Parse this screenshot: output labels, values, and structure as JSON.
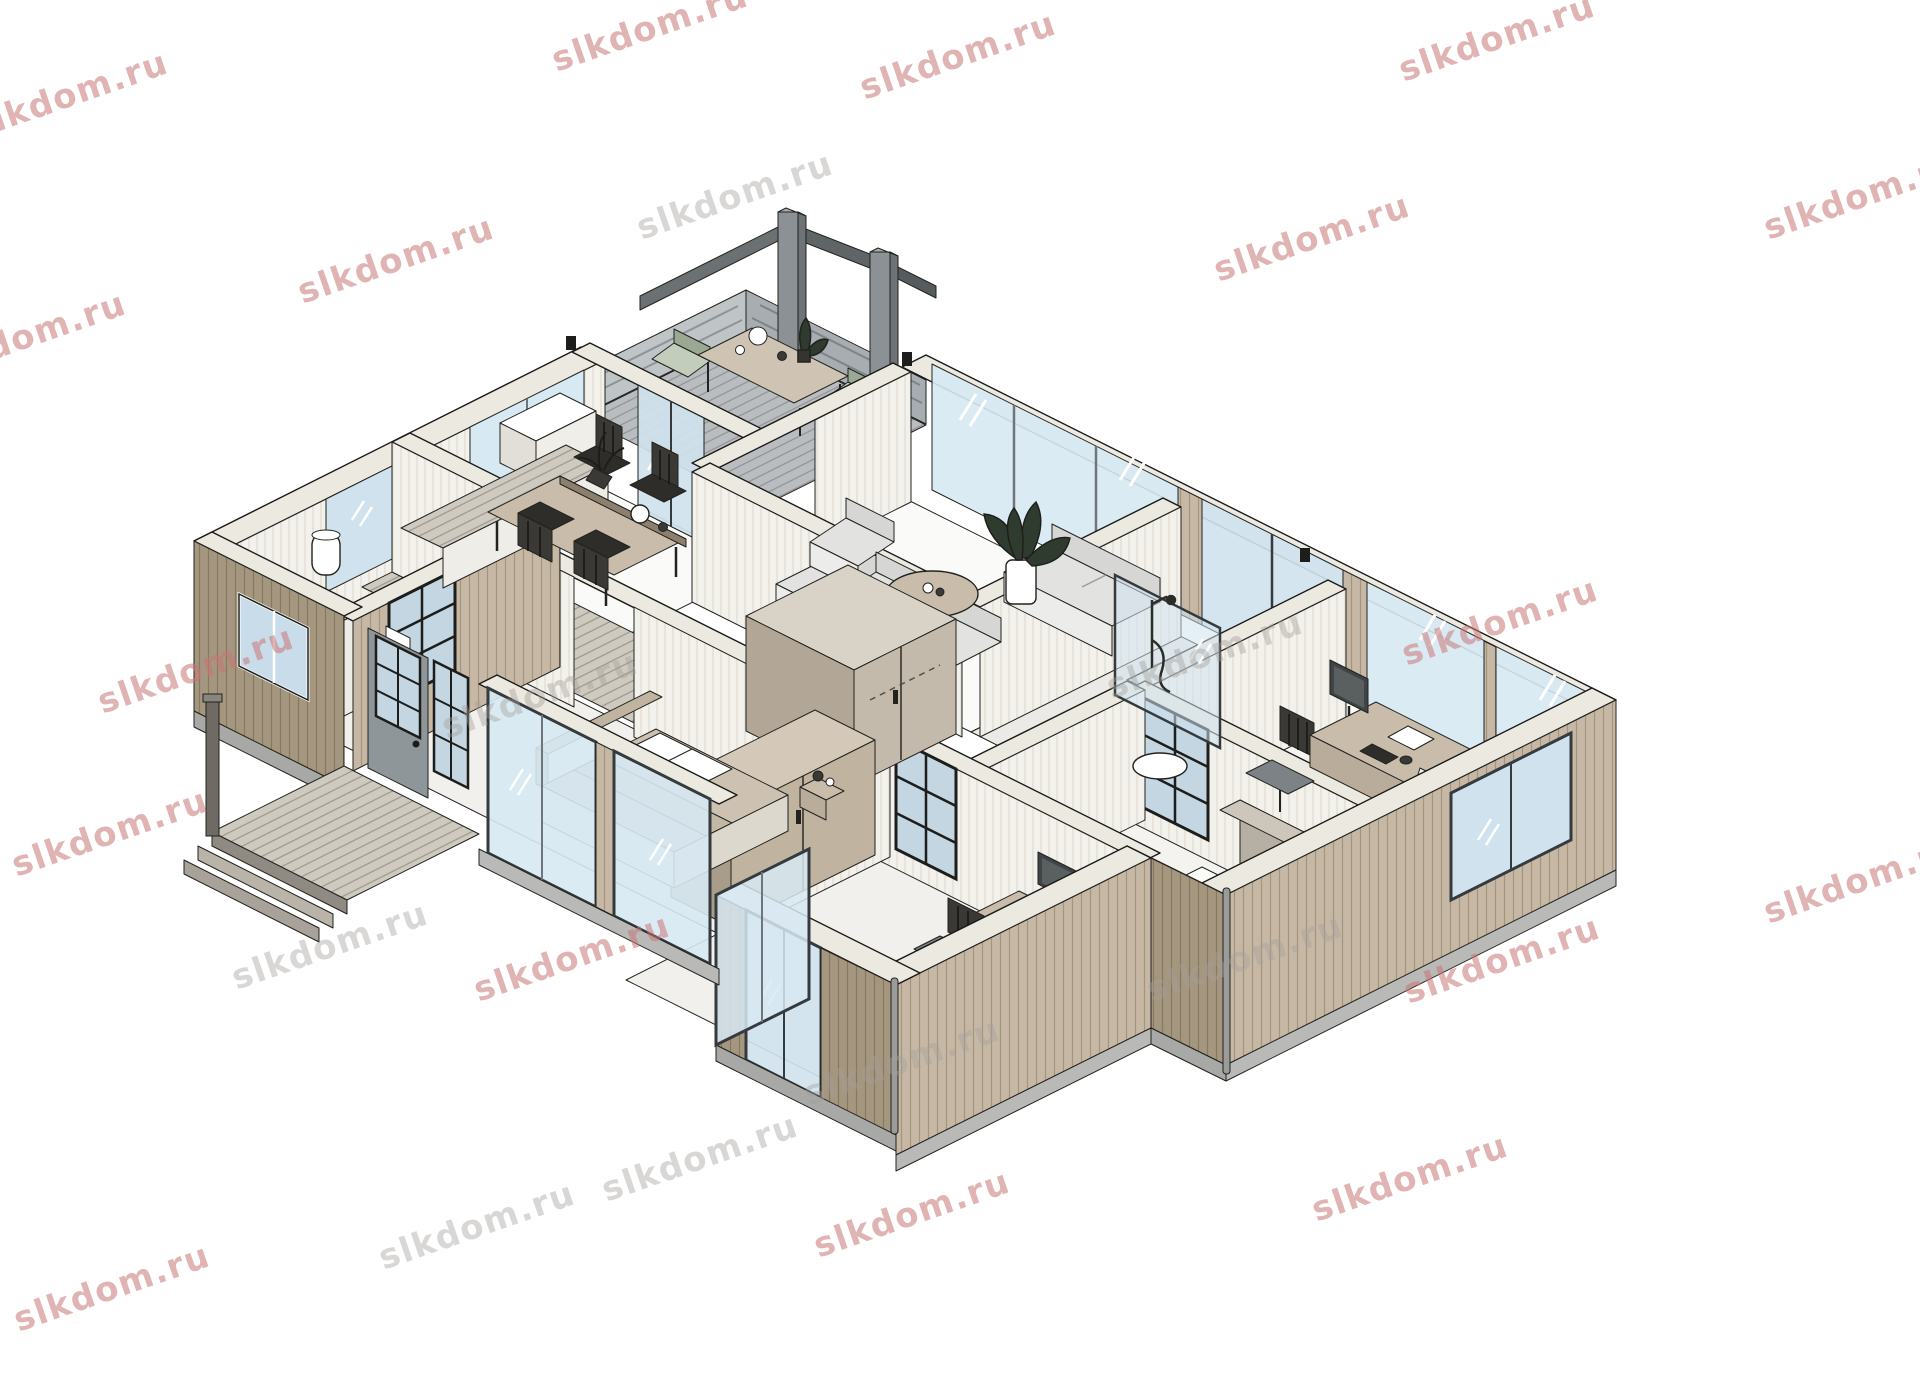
{
  "app": {
    "type": "isometric-3d-floor-plan-render",
    "background": "#ffffff"
  },
  "watermark": {
    "text": "slkdom.ru",
    "red_color": "#c97676",
    "gray_color": "#a4a09c",
    "items": [
      {
        "x": 70,
        "y": 95,
        "tone": "r"
      },
      {
        "x": 650,
        "y": 28,
        "tone": "r"
      },
      {
        "x": 958,
        "y": 56,
        "tone": "r"
      },
      {
        "x": 1497,
        "y": 38,
        "tone": "r"
      },
      {
        "x": 1862,
        "y": 196,
        "tone": "r"
      },
      {
        "x": 28,
        "y": 336,
        "tone": "r"
      },
      {
        "x": 396,
        "y": 260,
        "tone": "r"
      },
      {
        "x": 735,
        "y": 196,
        "tone": "g"
      },
      {
        "x": 1312,
        "y": 238,
        "tone": "r"
      },
      {
        "x": 196,
        "y": 670,
        "tone": "r"
      },
      {
        "x": 540,
        "y": 695,
        "tone": "g"
      },
      {
        "x": 1205,
        "y": 655,
        "tone": "g"
      },
      {
        "x": 1500,
        "y": 622,
        "tone": "r"
      },
      {
        "x": 110,
        "y": 833,
        "tone": "r"
      },
      {
        "x": 330,
        "y": 946,
        "tone": "g"
      },
      {
        "x": 572,
        "y": 958,
        "tone": "r"
      },
      {
        "x": 902,
        "y": 1062,
        "tone": "g"
      },
      {
        "x": 1245,
        "y": 958,
        "tone": "g"
      },
      {
        "x": 1502,
        "y": 960,
        "tone": "r"
      },
      {
        "x": 1862,
        "y": 880,
        "tone": "r"
      },
      {
        "x": 477,
        "y": 1226,
        "tone": "g"
      },
      {
        "x": 700,
        "y": 1158,
        "tone": "g"
      },
      {
        "x": 912,
        "y": 1214,
        "tone": "r"
      },
      {
        "x": 1410,
        "y": 1178,
        "tone": "r"
      },
      {
        "x": 112,
        "y": 1288,
        "tone": "r"
      }
    ]
  },
  "palette": {
    "linework": "#22221f",
    "wall_cut_band": "#ece9e0",
    "cladding_light": "#c6b8a5",
    "cladding_light_stripe": "#a4957f",
    "cladding_dark": "#a5967f",
    "cladding_dark_stripe": "#877862",
    "interior_panel": "#f3f1eb",
    "interior_panel_stripe": "#ddd8cd",
    "glass": "#d7e9f3",
    "glass_frame": "#343a3e",
    "deck_gray": "#b9bdc0",
    "floor_white": "#fafaf8",
    "floor_gray": "#f0eeea",
    "furniture_gray": "#e2e2e0",
    "furniture_tan": "#c9bcab",
    "chair_dark": "#2e2d2a",
    "sage_cushion": "#c2cdbb",
    "plant_green": "#2f3b2e",
    "base_slab": "#b9b9b7"
  },
  "scene_objects": {
    "rooms": [
      "terrace",
      "dining-area",
      "kitchen",
      "living-room",
      "bathroom",
      "entrance-porch",
      "hallway",
      "bedroom-1",
      "bedroom-2-desk-room",
      "shower-room",
      "office-room",
      "guest-room"
    ],
    "furniture": [
      "pergola-posts",
      "outdoor-dining-set",
      "dining-table",
      "dining-chairs",
      "kitchen-counter",
      "wall-cabinet",
      "toilet",
      "water-heater",
      "sofa-3-seat",
      "sofa-2-seat",
      "armchairs",
      "round-coffee-table",
      "monstera-plant",
      "double-bed",
      "nightstand",
      "wardrobe",
      "closet-gray-doors",
      "desk-with-monitor",
      "desk-chair",
      "floor-lamp",
      "shower-glass",
      "guest-mattress",
      "front-door",
      "porch-steps",
      "downpipes"
    ]
  }
}
